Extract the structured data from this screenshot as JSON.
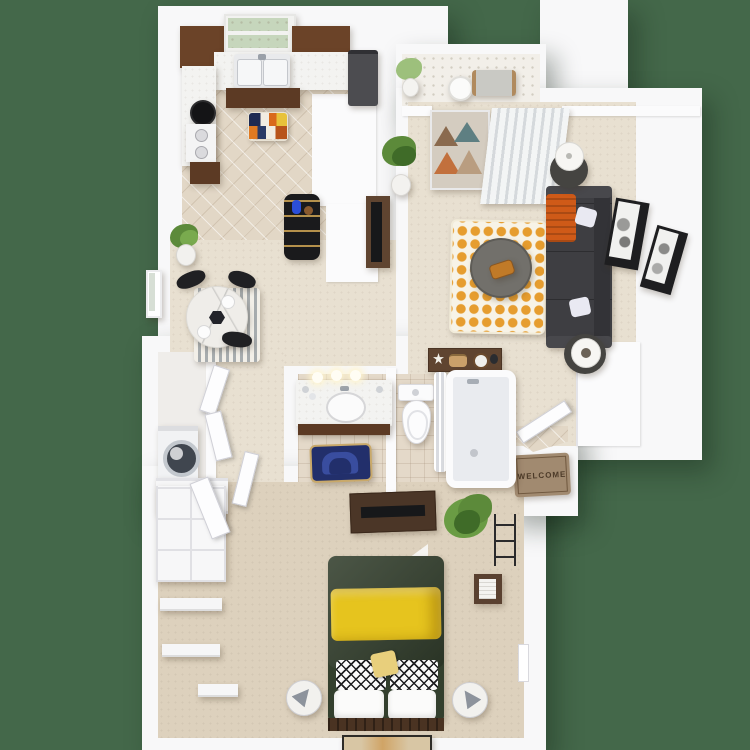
{
  "doormat": {
    "text": "WELCOME"
  },
  "colors": {
    "background": "#44684a",
    "wall": "#f8f8f9",
    "tileKitchen": "#e2d7c6",
    "tileBath": "#e4d9c9",
    "tileFoyer": "#f2efe9",
    "carpetMain": "#e8e0d1",
    "carpetBedroom": "#ddd1bd",
    "laundryFloor": "#efedea",
    "cabinetUpper": "#6b4328",
    "cabinetBase": "#5c3a24",
    "counter": "#f3f3f1",
    "refrigerator": "#4c4c50",
    "sofa": "#3e3e42",
    "throwOrange": "#cf5a18",
    "rugOrange": "#e69d2f",
    "rugCream": "#f7f3e7",
    "coffeeTable": "#72706b",
    "sideTable": "#454441",
    "lampShade": "#f7f6f3",
    "marbleTable": "#efede9",
    "chairBlack": "#202023",
    "barShelf": "#1a1a1c",
    "duvetGreen": "#333f2d",
    "blanketYellow": "#e6c41e",
    "headboard": "#4a3322",
    "dresser": "#4b3627",
    "tvBlack": "#17181a",
    "doormatBase": "#a18a70",
    "bathRugNavy": "#222f6b",
    "bathRugBlue": "#3d52a8",
    "plantGreen": "#5c8a3a",
    "deskWood": "#5f4430",
    "artFrame": "#1e1e20",
    "windowGlass": "#c6d6bc"
  }
}
